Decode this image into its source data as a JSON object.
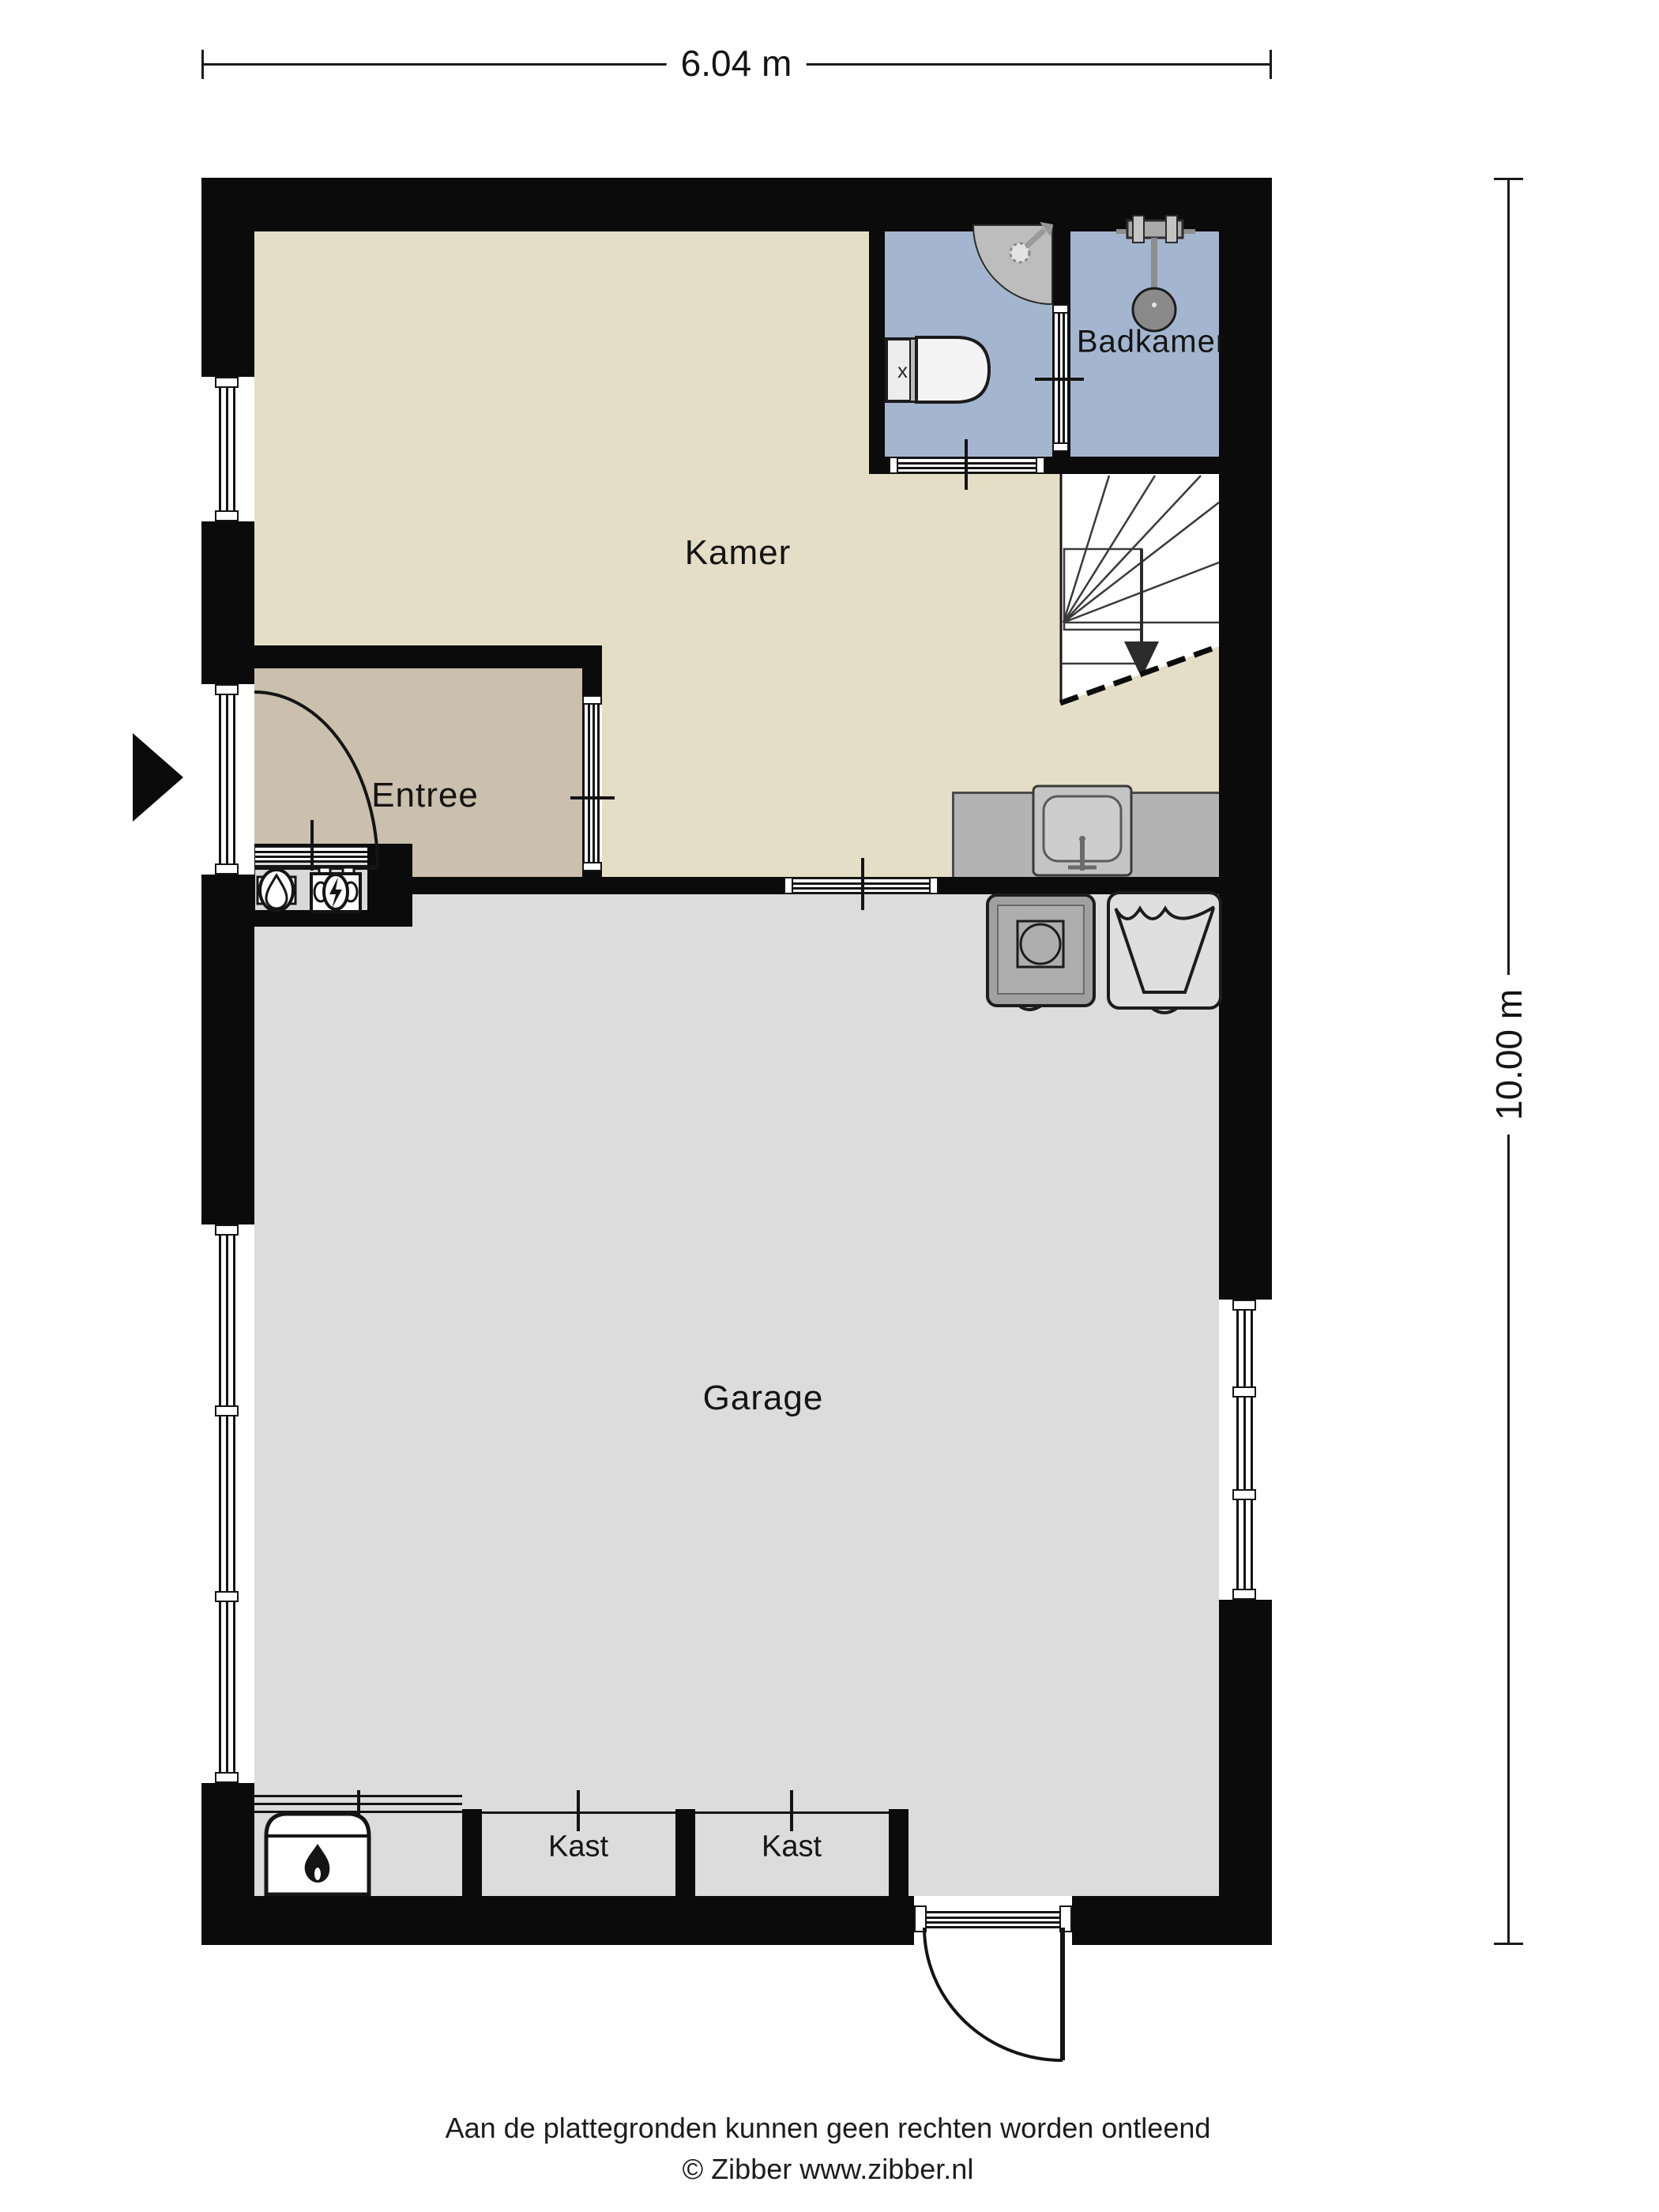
{
  "meta": {
    "type": "floor-plan",
    "floor": "begane grond / garage niveau"
  },
  "dimensions": {
    "width_label": "6.04 m",
    "height_label": "10.00 m"
  },
  "rooms": {
    "kamer": "Kamer",
    "badkamer": "Badkamer",
    "entree": "Entree",
    "garage": "Garage",
    "kast1": "Kast",
    "kast2": "Kast"
  },
  "footer": {
    "disclaimer": "Aan de plattegronden kunnen geen rechten worden ontleend",
    "copyright": "© Zibber www.zibber.nl"
  },
  "colors": {
    "wall": "#0b0b0b",
    "kamer_floor": "#e5dec6",
    "entree_floor": "#cbbfad",
    "bathroom_floor": "#a4b6cf",
    "garage_floor": "#dcdcdc",
    "counter": "#b3b3b3",
    "line": "#141414"
  },
  "icons": {
    "entrance_arrow": "entrance-arrow-icon",
    "shower_corner": "corner-shower-icon",
    "shower_head": "shower-head-icon",
    "toilet": "toilet-icon",
    "sink": "kitchen-sink-icon",
    "washing_machine": "washing-machine-icon",
    "laundry_tub": "laundry-tub-icon",
    "water_meter": "water-meter-icon",
    "electricity_meter": "electricity-meter-icon",
    "boiler": "boiler-flame-icon",
    "stairs": "stairs-down-icon"
  }
}
